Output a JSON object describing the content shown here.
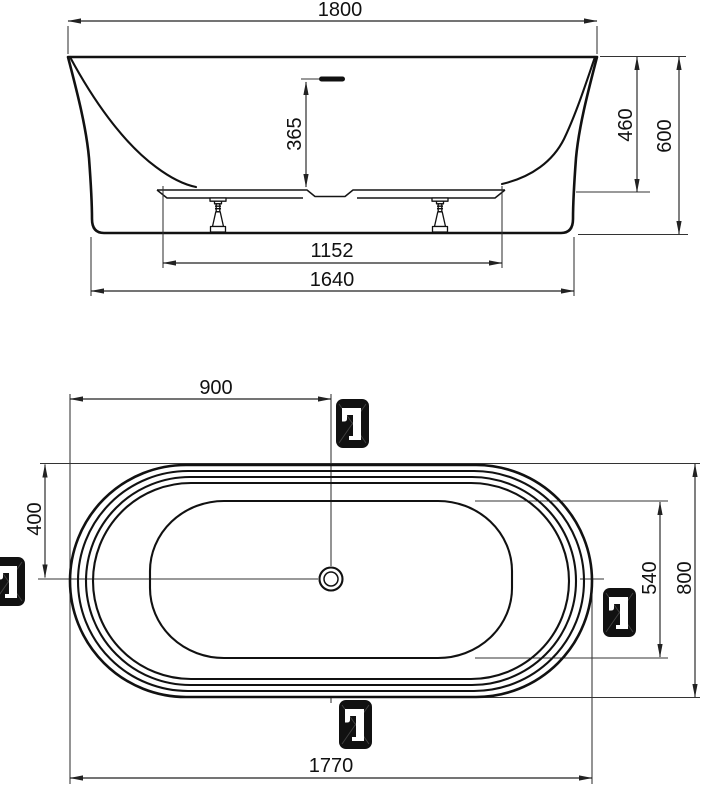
{
  "drawing": {
    "subject": "bathtub-dimension-drawing",
    "views": [
      "front-elevation",
      "plan-view"
    ]
  },
  "colors": {
    "line": "#111111",
    "dimension_line": "#222222",
    "badge_background": "#111111",
    "badge_glyph": "#ffffff",
    "background": "#ffffff"
  },
  "front_view": {
    "dims": {
      "width_top": "1800",
      "overflow_depth": "365",
      "inner_height": "460",
      "total_height": "600",
      "support_span": "1152",
      "base_width": "1640"
    }
  },
  "plan_view": {
    "dims": {
      "center_from_left": "900",
      "center_from_top": "400",
      "inner_width": "540",
      "total_width": "800",
      "total_length": "1770"
    },
    "faucet_markers": [
      {
        "icon": "freestanding-faucet-icon",
        "position": "top"
      },
      {
        "icon": "freestanding-faucet-icon",
        "position": "left"
      },
      {
        "icon": "freestanding-faucet-icon",
        "position": "right"
      },
      {
        "icon": "freestanding-faucet-icon",
        "position": "bottom"
      }
    ]
  }
}
